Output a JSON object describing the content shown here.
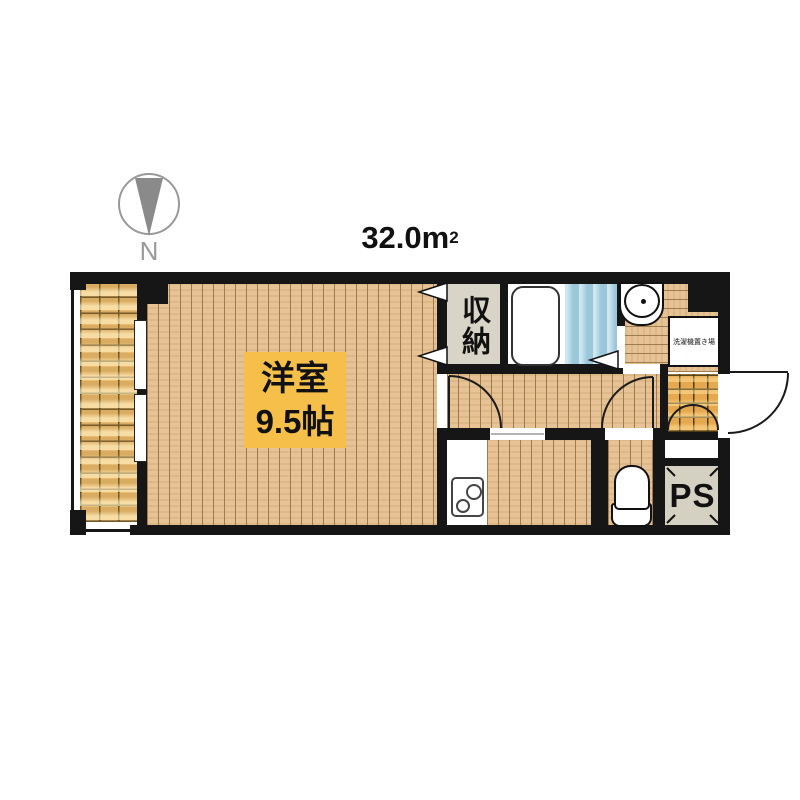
{
  "floorplan": {
    "area": {
      "value": "32.0m",
      "sup": "2"
    },
    "compass": {
      "label": "N"
    },
    "main_room": {
      "name": "洋室",
      "size": "9.5帖"
    },
    "closet": {
      "label": "収納"
    },
    "pipe_space": {
      "label": "PS"
    },
    "laundry_space": {
      "label": "洗濯機置き場"
    },
    "colors": {
      "wall": "#161616",
      "wood_floor": "#E6C294",
      "balcony_tile": "#E8BC72",
      "genkan_tile": "#E6A84E",
      "bath_floor": "#A9D4E4",
      "room_label_bg": "#F5BF4A",
      "closet_bg": "#D8D4C7",
      "ps_bg": "#D4D1C3"
    }
  }
}
